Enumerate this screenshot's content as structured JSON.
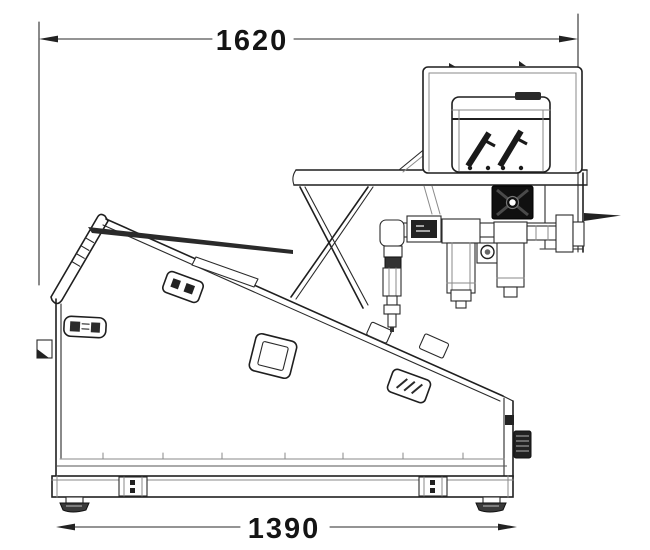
{
  "canvas": {
    "width": 650,
    "height": 550,
    "background": "#ffffff",
    "line_color": "#1f1f1f"
  },
  "dimensions": {
    "top": {
      "value": "1620"
    },
    "bottom": {
      "value": "1390"
    }
  },
  "parts": [
    "overall-width-dimension",
    "base-length-dimension",
    "electrical-cabinet",
    "pump-motor-unit",
    "cooling-fan",
    "air-filter-regulator-unit",
    "air-pipe-assembly",
    "shelf-support-frame",
    "inclined-cover",
    "left-display-panel",
    "control-label",
    "nameplate-diamond",
    "base-rail",
    "leveling-foot"
  ]
}
